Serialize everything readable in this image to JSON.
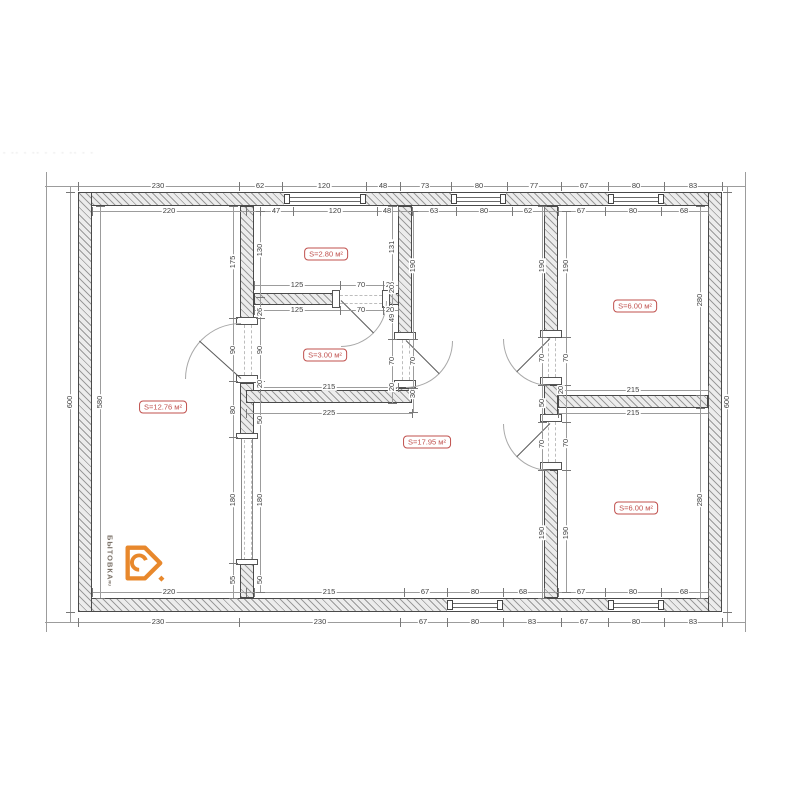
{
  "watermark": "- -- - -- -   - - -- - -",
  "rooms": [
    {
      "label": "S=12.76 м²"
    },
    {
      "label": "S=2.80 м²"
    },
    {
      "label": "S=3.00 м²"
    },
    {
      "label": "S=17.95 м²"
    },
    {
      "label": "S=6.00 м²"
    },
    {
      "label": "S=6.00 м²"
    }
  ],
  "dims": {
    "top_outer": [
      "230",
      "62",
      "120",
      "48",
      "73",
      "80",
      "77",
      "67",
      "80",
      "83"
    ],
    "top_inner": [
      "220",
      "47",
      "120",
      "48",
      "63",
      "80",
      "62",
      "67",
      "80",
      "68"
    ],
    "bottom_inner": [
      "220",
      "215",
      "67",
      "80",
      "68",
      "67",
      "80",
      "68"
    ],
    "bottom_outer": [
      "230",
      "230",
      "67",
      "80",
      "83",
      "67",
      "80",
      "83"
    ],
    "left": [
      "600",
      "580"
    ],
    "right": [
      "600",
      "280",
      "280"
    ],
    "wall_a_left": [
      "175",
      "90",
      "80",
      "180",
      "55"
    ],
    "wall_a_right": [
      "130",
      "26",
      "90",
      "20",
      "50",
      "180",
      "50"
    ],
    "room_280": [
      "125",
      "70",
      "20",
      "125",
      "70",
      "20"
    ],
    "wall_b_left": [
      "131",
      "20",
      "49",
      "70",
      "20"
    ],
    "wall_b_right": [
      "190",
      "70",
      "30"
    ],
    "room_300_bottom": [
      "215",
      "225"
    ],
    "wall_c_left": [
      "190",
      "70",
      "50",
      "70",
      "190"
    ],
    "wall_c_right": [
      "190",
      "70",
      "70",
      "190"
    ],
    "wall_d": [
      "20",
      "215",
      "215"
    ]
  },
  "logo": {
    "name": "БЫТОВКА",
    "tld": "RU"
  },
  "colors": {
    "room_label": "#c0504d",
    "logo_orange": "#e8882c",
    "wall_hatch": "#9a9a9a",
    "dim_line": "#9c9c9c"
  }
}
